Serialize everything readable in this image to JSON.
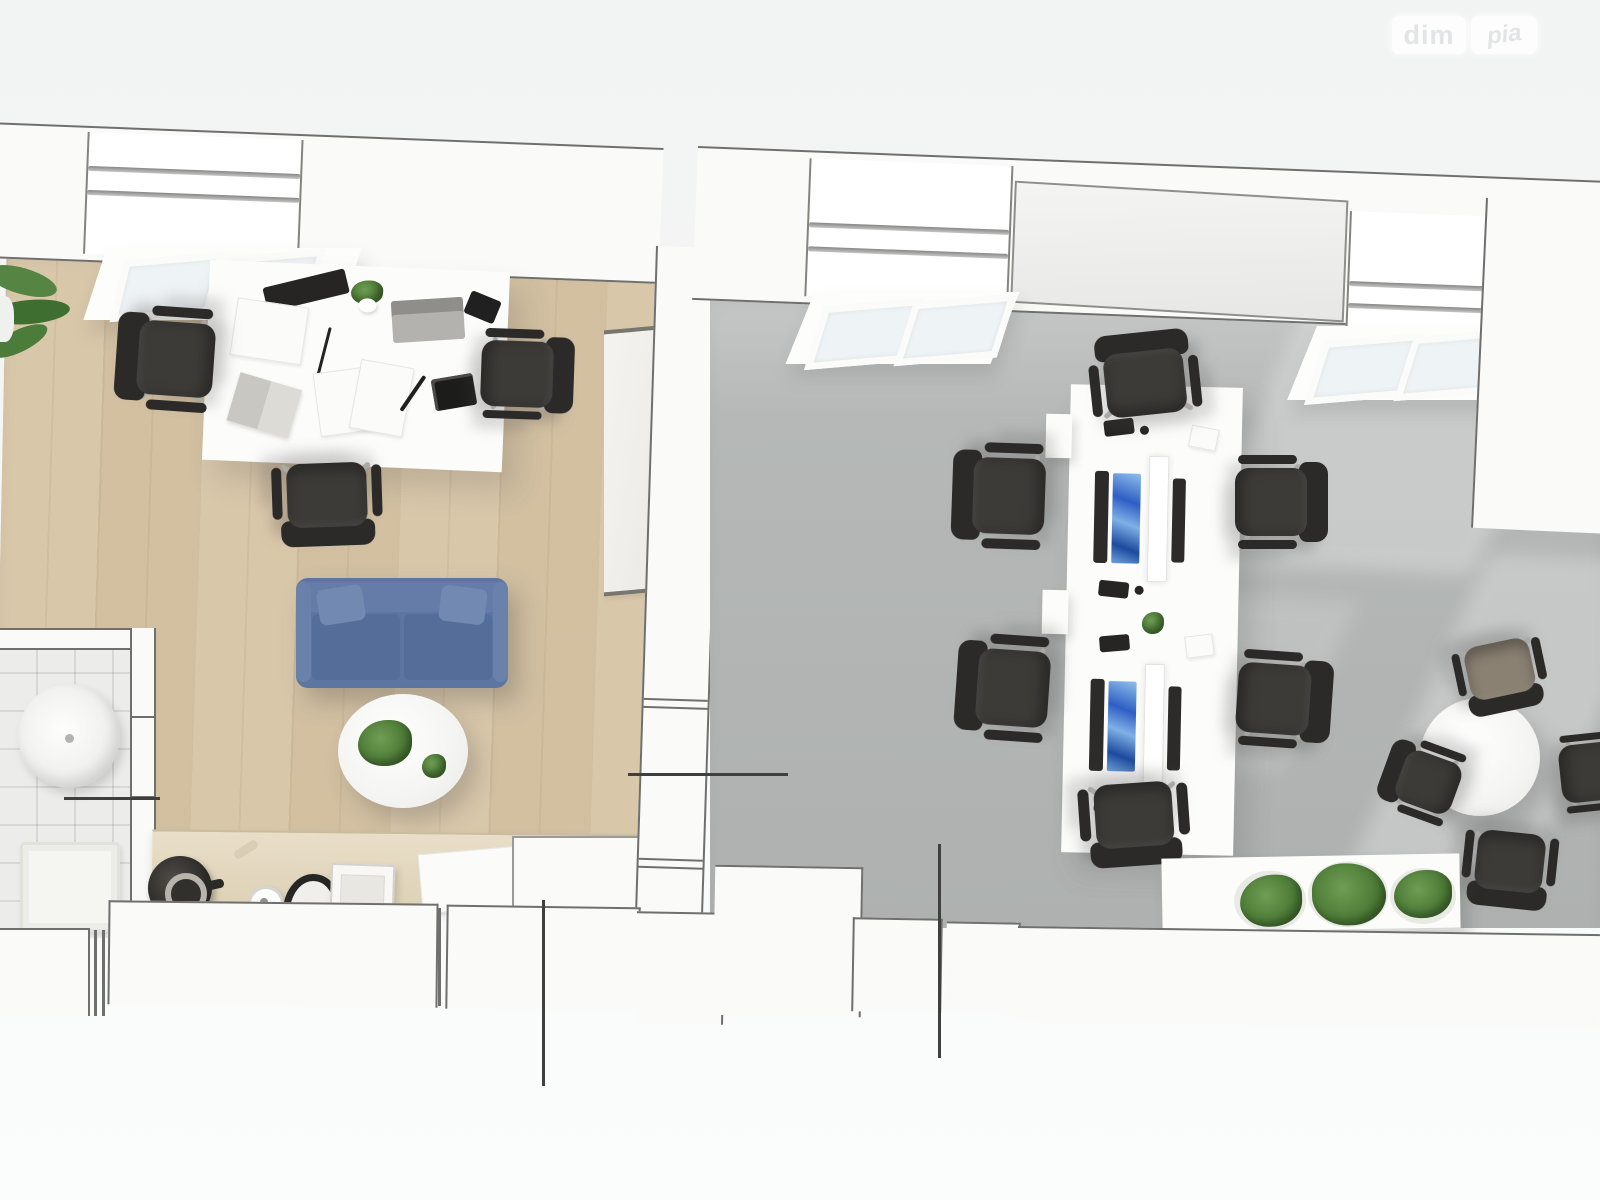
{
  "watermark": {
    "brand_left": "dim",
    "brand_right": "ріа"
  },
  "scene": {
    "type": "3d-rendered-top-down-floorplan",
    "rooms": [
      {
        "id": "office-lounge",
        "floor": "light-wood",
        "contents": [
          "executive-desk",
          "office-chair",
          "office-chair",
          "office-chair",
          "sofa",
          "coffee-table",
          "potted-plant",
          "whiteboard",
          "kitchen-counter",
          "kettle",
          "cup",
          "egg-cooker",
          "small-appliance",
          "papers",
          "corner-plant",
          "skylight-window"
        ]
      },
      {
        "id": "bathroom",
        "floor": "white-tile",
        "contents": [
          "wash-basin",
          "bath-mat"
        ]
      },
      {
        "id": "open-office",
        "floor": "gray-concrete",
        "contents": [
          "bench-desk",
          "monitor",
          "monitor",
          "acoustic-divider",
          "office-chair",
          "office-chair",
          "office-chair",
          "office-chair",
          "office-chair",
          "office-chair",
          "meeting-table",
          "meeting-chair",
          "meeting-chair",
          "meeting-chair",
          "meeting-chair",
          "planter-box",
          "plant",
          "plant",
          "plant",
          "skylight-window",
          "skylight-window",
          "sunlight-patches"
        ]
      }
    ],
    "annotations": [
      "leader-line-horizontal-bathroom",
      "leader-line-horizontal-partition",
      "leader-line-vertical-left",
      "leader-line-vertical-right"
    ]
  },
  "colors": {
    "bg": "#f5f6f6",
    "wall": "#fafaf9",
    "wallLine": "#6f6f6e",
    "wood": "#d7c4a5",
    "tile": "#ecedeb",
    "grayfloor": "#b5b8b7",
    "sofa": "#5d76a1",
    "sofaDark": "#546d99",
    "chair": "#3d3b38",
    "chairDark": "#2b2a28",
    "tanChair": "#8a8172",
    "plant": "#4e7d38",
    "plantDark": "#3a6128",
    "screen": "#2e5ec4",
    "screenLight": "#7fb0e6",
    "whiteFurn": "#fcfcfb",
    "counter": "#ddd2b6",
    "annotation": "#3f3f3d"
  }
}
